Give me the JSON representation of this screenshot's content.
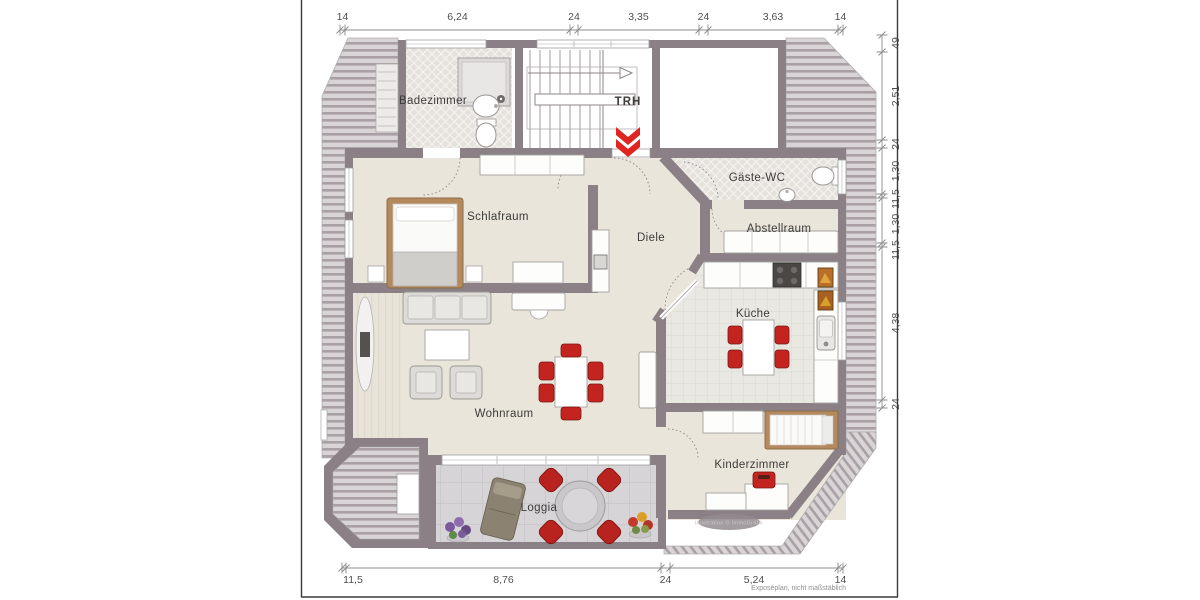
{
  "plan": {
    "rooms": {
      "badezimmer": "Badezimmer",
      "trh": "TRH",
      "schlafraum": "Schlafraum",
      "diele": "Diele",
      "gaeste_wc": "Gäste-WC",
      "abstellraum": "Abstellraum",
      "kueche": "Küche",
      "wohnraum": "Wohnraum",
      "kinderzimmer": "Kinderzimmer",
      "loggia": "Loggia"
    },
    "dimensions": {
      "top": [
        "14",
        "6,24",
        "24",
        "3,35",
        "24",
        "3,63",
        "14"
      ],
      "right": [
        "49",
        "2,51",
        "24",
        "1,30",
        "11,5",
        "1,30",
        "11,5",
        "4,38",
        "24"
      ],
      "bottom": [
        "11,5",
        "8,76",
        "24",
        "5,24",
        "14"
      ]
    },
    "footnote": "Exposéplan, nicht maßstäblich",
    "watermark": "Illustration © ImmoGrafik"
  },
  "colors": {
    "wall": "#8a8086",
    "floor": "#eae5da",
    "accent_red": "#d8241f",
    "hatch_stripe": "#a8a0a5",
    "wood": "#b5895e"
  }
}
